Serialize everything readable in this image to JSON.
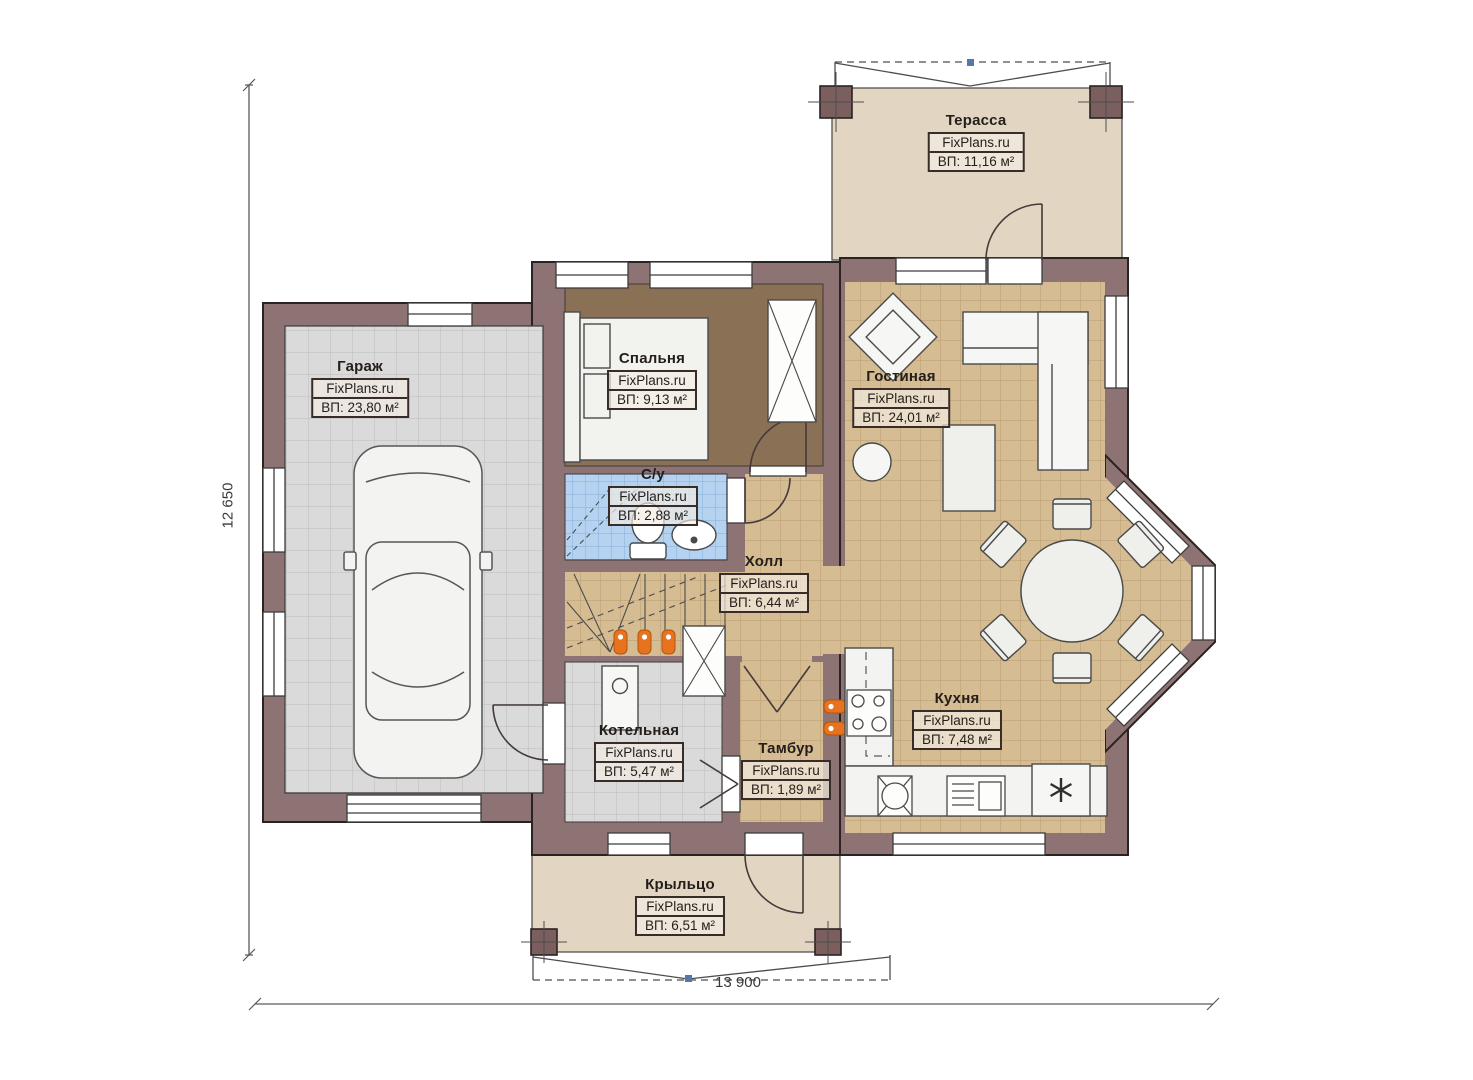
{
  "watermark": "FixPlans.ru",
  "plan": {
    "dimension_width": "13 900",
    "dimension_height": "12 650"
  },
  "rooms": {
    "terrace": {
      "name": "Терасса",
      "area": "ВП: 11,16 м²"
    },
    "garage": {
      "name": "Гараж",
      "area": "ВП: 23,80 м²"
    },
    "bedroom": {
      "name": "Спальня",
      "area": "ВП: 9,13 м²"
    },
    "living": {
      "name": "Гостиная",
      "area": "ВП: 24,01 м²"
    },
    "bathroom": {
      "name": "С/у",
      "area": "ВП: 2,88 м²"
    },
    "hall": {
      "name": "Холл",
      "area": "ВП: 6,44 м²"
    },
    "boiler": {
      "name": "Котельная",
      "area": "ВП: 5,47 м²"
    },
    "vestibule": {
      "name": "Тамбур",
      "area": "ВП: 1,89 м²"
    },
    "kitchen": {
      "name": "Кухня",
      "area": "ВП: 7,48 м²"
    },
    "porch": {
      "name": "Крыльцо",
      "area": "ВП: 6,51 м²"
    }
  },
  "colors": {
    "wall": "#8d7373",
    "wall_outline": "#2b2323",
    "floor_tan": "#d5bc92",
    "floor_gray": "#dadada",
    "floor_blue": "#b5d3f0",
    "floor_brown": "#8a7054",
    "floor_beige": "#e2d6c2",
    "radiator": "#e8731e",
    "marker_blue": "#5577aa"
  }
}
